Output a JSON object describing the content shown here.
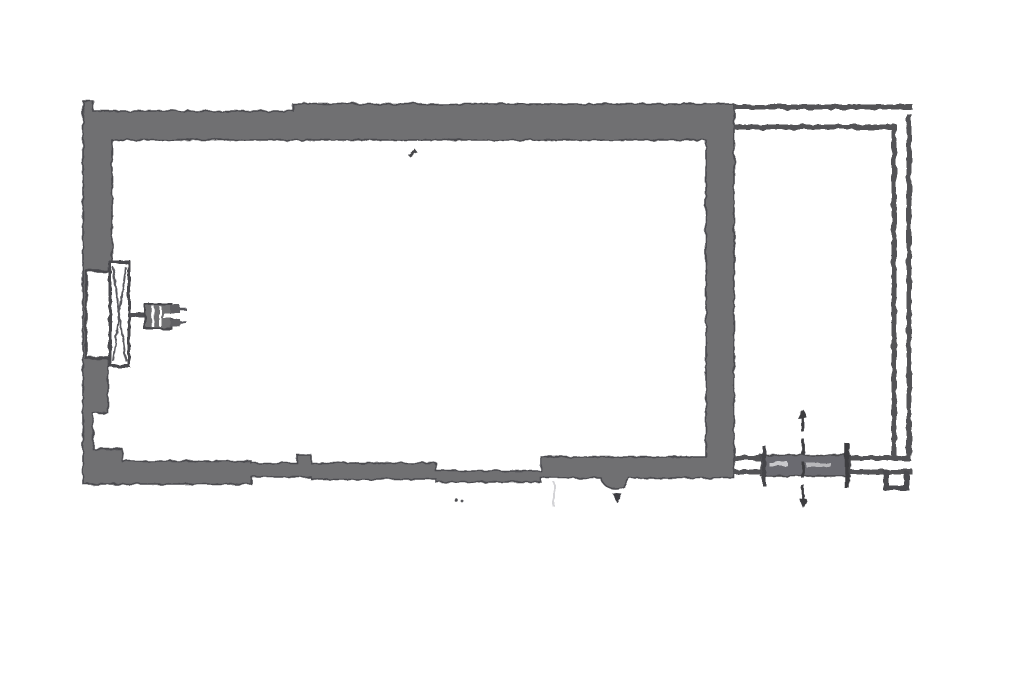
{
  "meta": {
    "description": "Scanned grayscale architectural floor plan: one large rectangular room with thick gray walls, a window with fan symbol on the left wall, a narrow annex drawn with thin double lines on the right side, and a sliding door with dashed centerline at the bottom right"
  },
  "canvas": {
    "width": 1024,
    "height": 683,
    "background": "#ffffff"
  },
  "palette": {
    "wall_fill": "#6f6f72",
    "wall_edge": "#4a4a4e",
    "thin_line": "#525256",
    "dark_line": "#3d3d41",
    "faint_line": "#d4d4d7",
    "paper": "#ffffff"
  },
  "plan": {
    "shapes": [
      {
        "name": "main-walls",
        "kind": "path",
        "attrs": {
          "d": "M83,101 L93,101 L93,111 L293,111 L293,104 L734,104 L734,478 L629,478 C626,492 604,492 601,478 L541,478 L541,482 L436,482 L436,479 L311,479 L311,477 L251,477 L251,484 L83,484 Z M112,140 L706,140 L706,457 L541,457 L541,471 L436,471 L436,463 L311,463 L311,455 L297,455 L297,463 L251,463 L251,461 L122,461 L122,449 L93,449 L93,413 L108,413 L108,268 L112,268 Z",
          "fill": "#6f6f72",
          "stroke": "#4a4a4e",
          "stroke-width": "1.6",
          "fill-rule": "evenodd"
        }
      },
      {
        "name": "window-opening",
        "kind": "rect",
        "attrs": {
          "x": "86",
          "y": "271",
          "width": "25",
          "height": "87",
          "fill": "#ffffff",
          "stroke": "#4a4a4e",
          "stroke-width": "2.6"
        }
      },
      {
        "name": "window-frame",
        "kind": "rect",
        "attrs": {
          "x": "110",
          "y": "262",
          "width": "19",
          "height": "104",
          "fill": "#ffffff",
          "stroke": "#4a4a4e",
          "stroke-width": "3"
        }
      },
      {
        "name": "window-frame-diagonals",
        "kind": "path",
        "attrs": {
          "d": "M113,267 L126,361 M126,267 L113,361",
          "fill": "none",
          "stroke": "#5a5a5e",
          "stroke-width": "2"
        }
      },
      {
        "name": "fan-stem",
        "kind": "line",
        "attrs": {
          "x1": "129",
          "y1": "315",
          "x2": "147",
          "y2": "315",
          "stroke": "#4f4f53",
          "stroke-width": "4"
        }
      },
      {
        "name": "fan-body",
        "kind": "rect",
        "attrs": {
          "x": "145",
          "y": "304",
          "width": "27",
          "height": "25",
          "fill": "#6f6f72",
          "stroke": "#47474b",
          "stroke-width": "2"
        }
      },
      {
        "name": "fan-body-slit-1",
        "kind": "line",
        "attrs": {
          "x1": "153",
          "y1": "306",
          "x2": "153",
          "y2": "327",
          "stroke": "#ffffff",
          "stroke-width": "2.5"
        }
      },
      {
        "name": "fan-body-slit-2",
        "kind": "line",
        "attrs": {
          "x1": "160",
          "y1": "306",
          "x2": "160",
          "y2": "327",
          "stroke": "#ffffff",
          "stroke-width": "2"
        }
      },
      {
        "name": "fan-body-gap",
        "kind": "rect",
        "attrs": {
          "x": "163",
          "y": "313",
          "width": "17",
          "height": "5",
          "fill": "#ffffff"
        }
      },
      {
        "name": "fan-tooth-top",
        "kind": "rect",
        "attrs": {
          "x": "170",
          "y": "305",
          "width": "10",
          "height": "8",
          "fill": "#5f5f63"
        }
      },
      {
        "name": "fan-tooth-bottom",
        "kind": "rect",
        "attrs": {
          "x": "170",
          "y": "319",
          "width": "10",
          "height": "8",
          "fill": "#5f5f63"
        }
      },
      {
        "name": "fan-tail-top",
        "kind": "line",
        "attrs": {
          "x1": "180",
          "y1": "309",
          "x2": "186",
          "y2": "309",
          "stroke": "#55555a",
          "stroke-width": "2.5"
        }
      },
      {
        "name": "fan-tail-bottom",
        "kind": "line",
        "attrs": {
          "x1": "180",
          "y1": "322",
          "x2": "186",
          "y2": "322",
          "stroke": "#55555a",
          "stroke-width": "2.5"
        }
      },
      {
        "name": "annex-top-outer-line",
        "kind": "line",
        "attrs": {
          "x1": "734",
          "y1": "107",
          "x2": "913",
          "y2": "107",
          "stroke": "#525256",
          "stroke-width": "5"
        }
      },
      {
        "name": "annex-top-inner-line",
        "kind": "line",
        "attrs": {
          "x1": "734",
          "y1": "127",
          "x2": "896",
          "y2": "127",
          "stroke": "#525256",
          "stroke-width": "5"
        }
      },
      {
        "name": "annex-right-inner-line",
        "kind": "line",
        "attrs": {
          "x1": "894",
          "y1": "124",
          "x2": "894",
          "y2": "456",
          "stroke": "#525256",
          "stroke-width": "5"
        }
      },
      {
        "name": "annex-right-outer-line",
        "kind": "line",
        "attrs": {
          "x1": "909",
          "y1": "114",
          "x2": "909",
          "y2": "456",
          "stroke": "#525256",
          "stroke-width": "5"
        }
      },
      {
        "name": "annex-bottom-upper-line",
        "kind": "line",
        "attrs": {
          "x1": "734",
          "y1": "458",
          "x2": "911",
          "y2": "458",
          "stroke": "#525256",
          "stroke-width": "5"
        }
      },
      {
        "name": "annex-bottom-lower-line",
        "kind": "line",
        "attrs": {
          "x1": "734",
          "y1": "472",
          "x2": "913",
          "y2": "472",
          "stroke": "#525256",
          "stroke-width": "5"
        }
      },
      {
        "name": "door-leaf",
        "kind": "rect",
        "attrs": {
          "x": "761",
          "y": "455",
          "width": "89",
          "height": "21",
          "fill": "#6b6b6f",
          "stroke": "#48484c",
          "stroke-width": "1.5"
        }
      },
      {
        "name": "door-leaf-streak-1",
        "kind": "rect",
        "attrs": {
          "x": "769",
          "y": "462",
          "width": "19",
          "height": "4",
          "fill": "#c9c9cc"
        }
      },
      {
        "name": "door-leaf-streak-2",
        "kind": "rect",
        "attrs": {
          "x": "806",
          "y": "463",
          "width": "25",
          "height": "4",
          "fill": "#b8b8bb"
        }
      },
      {
        "name": "door-jamb-left",
        "kind": "line",
        "attrs": {
          "x1": "764",
          "y1": "446",
          "x2": "764",
          "y2": "486",
          "stroke": "#45454a",
          "stroke-width": "4"
        }
      },
      {
        "name": "door-jamb-right",
        "kind": "line",
        "attrs": {
          "x1": "847",
          "y1": "443",
          "x2": "847",
          "y2": "488",
          "stroke": "#3d3d41",
          "stroke-width": "4.5"
        }
      },
      {
        "name": "door-centerline",
        "kind": "line",
        "attrs": {
          "x1": "803",
          "y1": "416",
          "x2": "803",
          "y2": "501",
          "stroke": "#3d3d41",
          "stroke-width": "2.8",
          "stroke-dasharray": "16 7"
        }
      },
      {
        "name": "door-centerline-tip-top",
        "kind": "path",
        "attrs": {
          "d": "M803,409 L798,419 L807,418 Z",
          "fill": "#3d3d41"
        }
      },
      {
        "name": "door-centerline-tip-bottom",
        "kind": "path",
        "attrs": {
          "d": "M803,508 L799,498 L807,499 Z",
          "fill": "#3d3d41"
        }
      },
      {
        "name": "threshold-step",
        "kind": "path",
        "attrs": {
          "d": "M886,470 L886,488 L907,488 L907,472",
          "fill": "none",
          "stroke": "#4c4c50",
          "stroke-width": "5"
        }
      },
      {
        "name": "scan-speck-mark",
        "kind": "path",
        "attrs": {
          "d": "M408,155 L415,149 L417,152 L410,157 Z",
          "fill": "#46464a"
        }
      },
      {
        "name": "scan-speck-dot-1",
        "kind": "circle",
        "attrs": {
          "cx": "456",
          "cy": "500",
          "r": "1.8",
          "fill": "#4c4c50"
        }
      },
      {
        "name": "scan-speck-dot-2",
        "kind": "circle",
        "attrs": {
          "cx": "462",
          "cy": "501",
          "r": "1.4",
          "fill": "#5a5a5e"
        }
      },
      {
        "name": "scan-speck-triangle",
        "kind": "path",
        "attrs": {
          "d": "M612,493 L622,494 L617,503 Z",
          "fill": "#3e3e42"
        }
      },
      {
        "name": "scan-faint-vertical-line",
        "kind": "line",
        "attrs": {
          "x1": "554",
          "y1": "482",
          "x2": "554",
          "y2": "507",
          "stroke": "#d4d4d7",
          "stroke-width": "2"
        }
      }
    ]
  }
}
